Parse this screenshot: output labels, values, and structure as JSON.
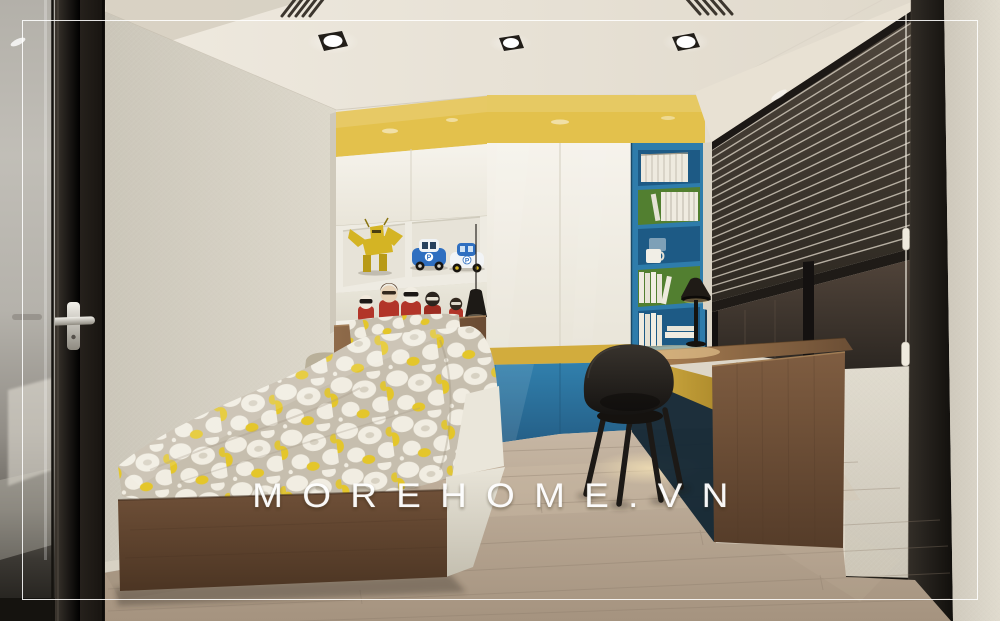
{
  "watermark": {
    "text": "MOREHOME.VN"
  },
  "toys": {
    "car_badge_letter": "P"
  },
  "scene": {
    "description": "3D render of a kids bedroom with yellow-white wardrobe, blue bookshelf niche, study desk by a blinded window, and a single bed with patterned bedding",
    "downlight_count": 3,
    "bookshelf_compartment_count": 5,
    "figurine_count": 5,
    "toy_car_count": 2
  },
  "colors": {
    "ceiling": "#ece6da",
    "wall_left": "#d8d3c6",
    "wall_outer": "#d9d4c7",
    "accent_yellow": "#e3c14c",
    "band_yellow": "#d2ac3d",
    "desk_fascia_yellow": "#c9a83c",
    "panel_blue": "#2e78a3",
    "bookshelf_blue": "#2e7cab",
    "bookshelf_back_blue": "#1d5a85",
    "bookshelf_back_green": "#527f30",
    "wood_desk_top": "#8a6644",
    "wood_desk_side": "#6b4d35",
    "wood_bed_base": "#61452f",
    "wood_headboard": "#7c5b3e",
    "floor_wood": "#b5a492",
    "blinds_dark": "#3b332b",
    "blind_slat": "#d6cec0",
    "frame_black": "#1e1a16",
    "chair_black": "#221f1c",
    "duvet_base": "#c6beae",
    "duvet_blob": "#f1ede2",
    "duvet_yellow": "#e4c62a",
    "pillow_khaki": "#b9b09a",
    "toy_red": "#b23529",
    "toy_yellow": "#d4b424",
    "toy_blue": "#2f6fc0",
    "white_cabinet": "#f2efe7",
    "watermark": "#ffffff"
  }
}
